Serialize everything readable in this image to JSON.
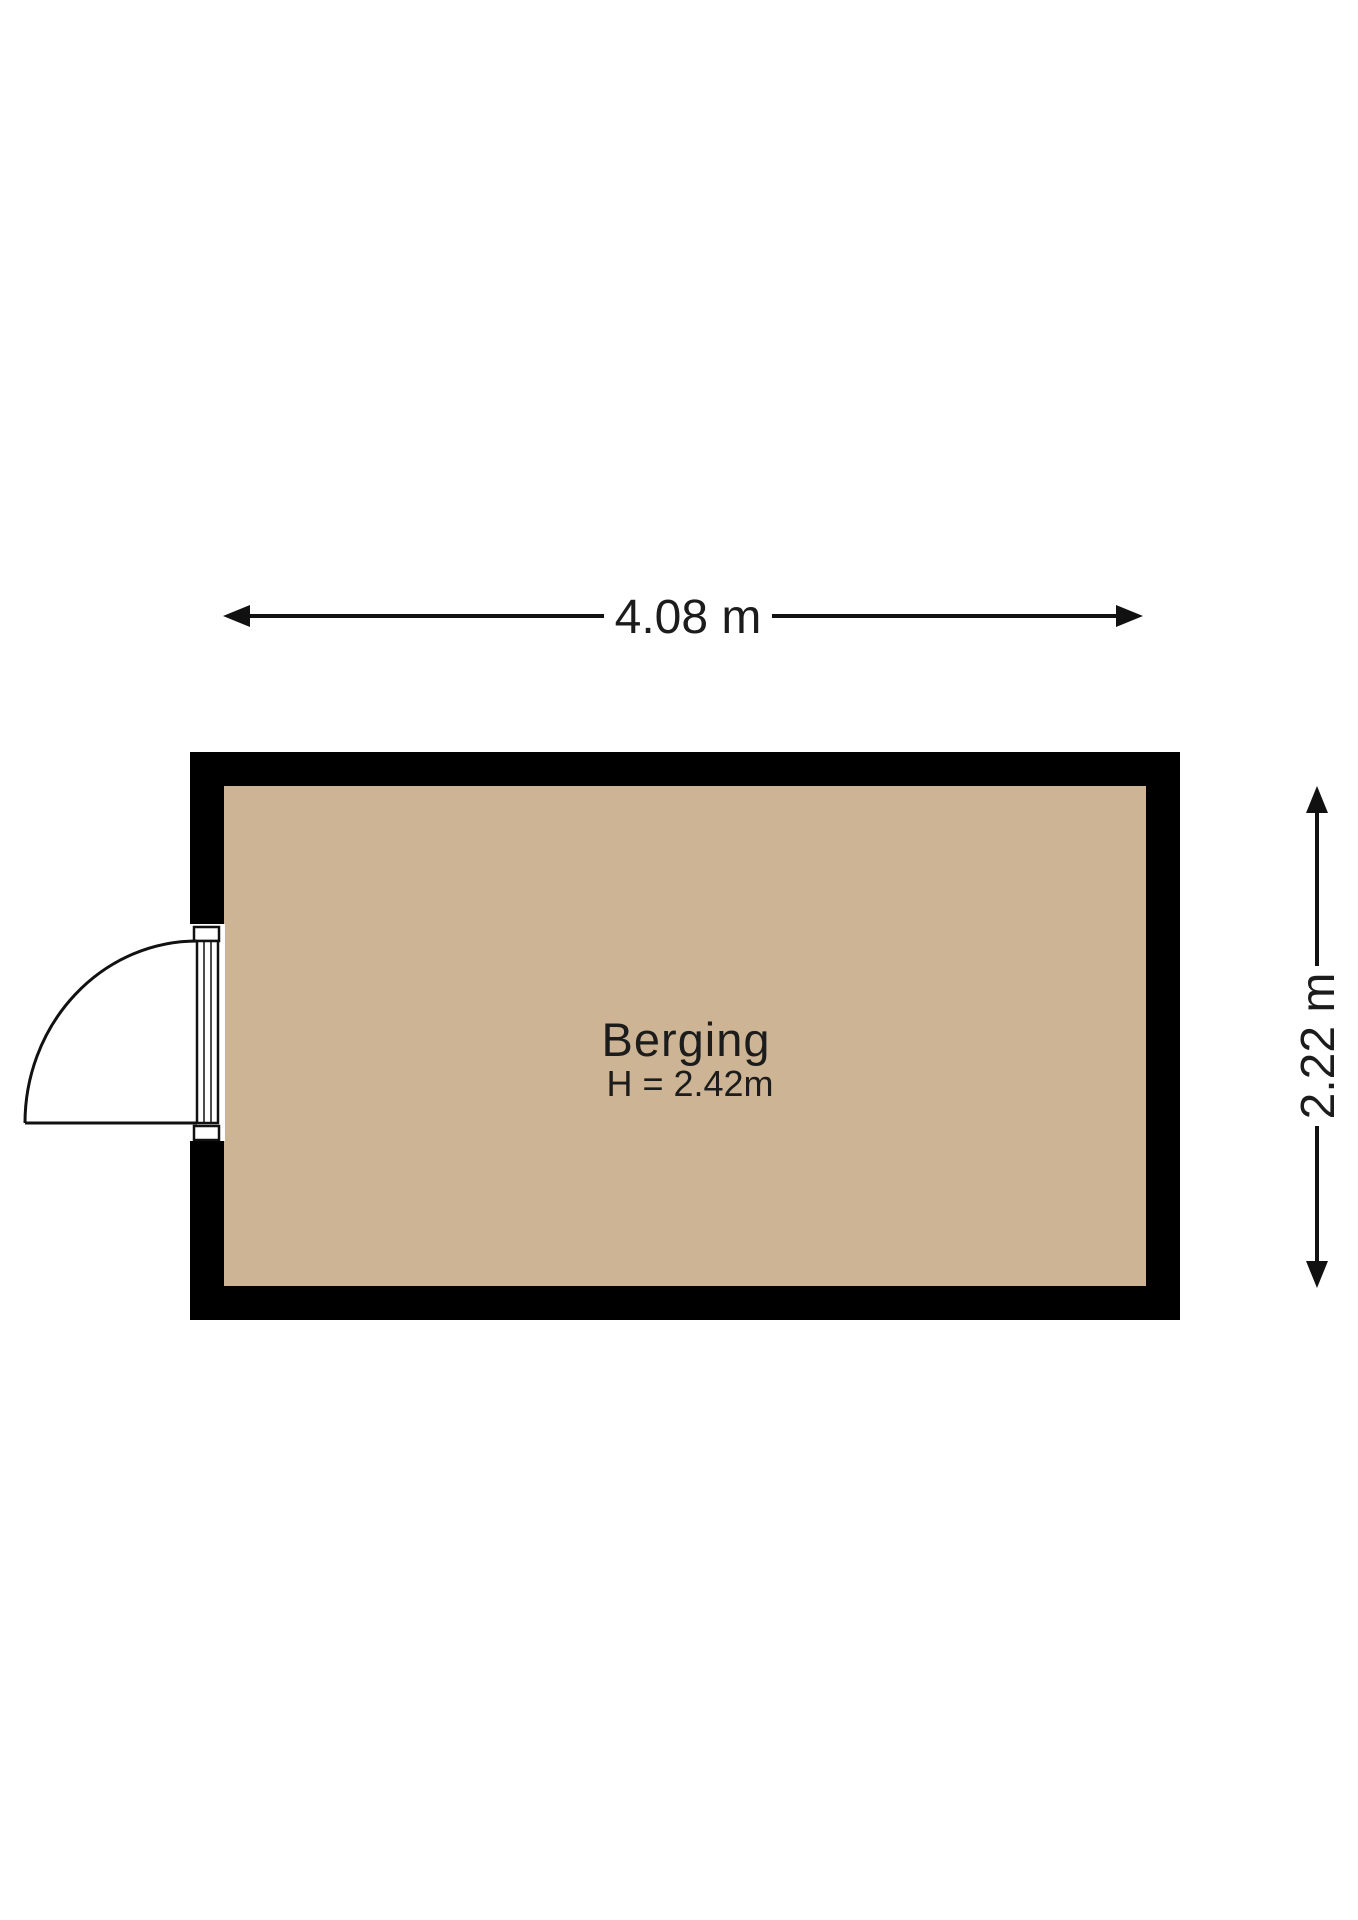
{
  "floorplan": {
    "room": {
      "name": "Berging",
      "ceiling_height_label": "H = 2.42m",
      "ceiling_height_m": 2.42
    },
    "dimensions": {
      "width": {
        "label": "4.08 m",
        "value_m": 4.08
      },
      "depth": {
        "label": "2.22 m",
        "value_m": 2.22
      }
    },
    "colors": {
      "floor": "#cdb494",
      "wall": "#000000",
      "line": "#111111",
      "background": "#ffffff"
    }
  }
}
